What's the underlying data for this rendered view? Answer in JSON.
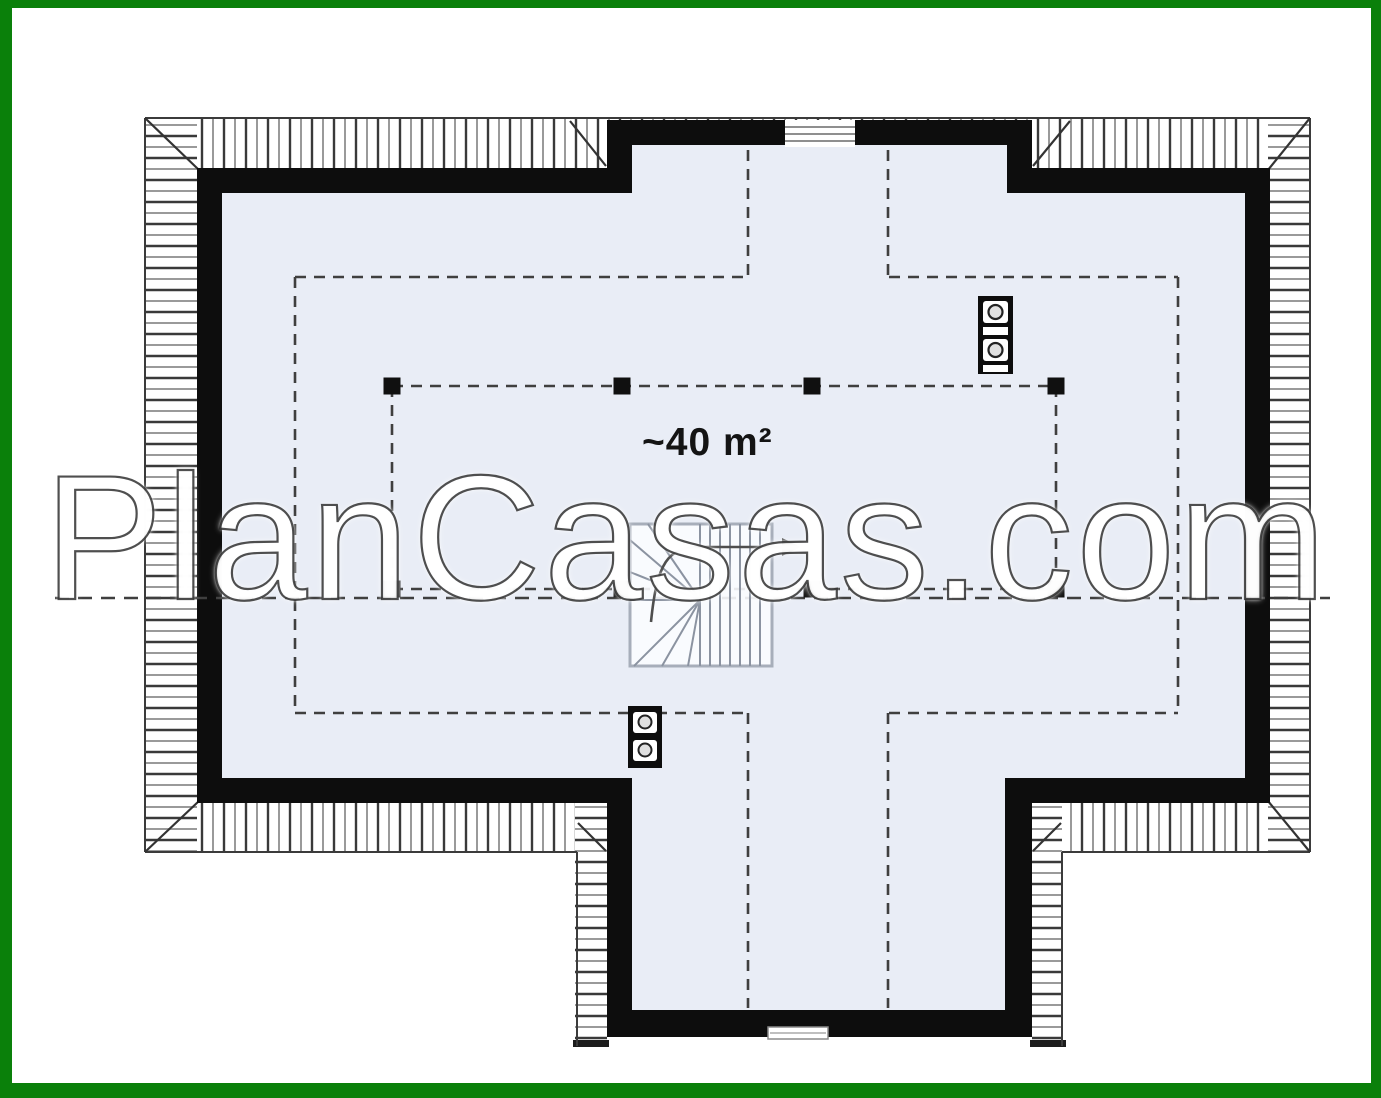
{
  "page": {
    "background": "#ffffff"
  },
  "frame": {
    "border_color": "#0a800a"
  },
  "plan": {
    "area_label": "~40 m²",
    "watermark": "PlanCasas.com",
    "colors": {
      "floor": "#e9edf6",
      "wall": "#0d0d0d",
      "roof_hatch_dark": "#3a3a3a",
      "roof_hatch_light": "#9a9a9a",
      "dashed_line": "#3f3f3f",
      "stair_line": "#8b93a1",
      "frame_green": "#0a800a"
    },
    "icons": {
      "chimney_upper": "chimney-flue-icon",
      "chimney_lower": "chimney-flue-icon",
      "stairs_arrow": "stairs-direction-arrow-icon",
      "window_upper": "window-icon",
      "window_lower": "window-icon"
    }
  }
}
